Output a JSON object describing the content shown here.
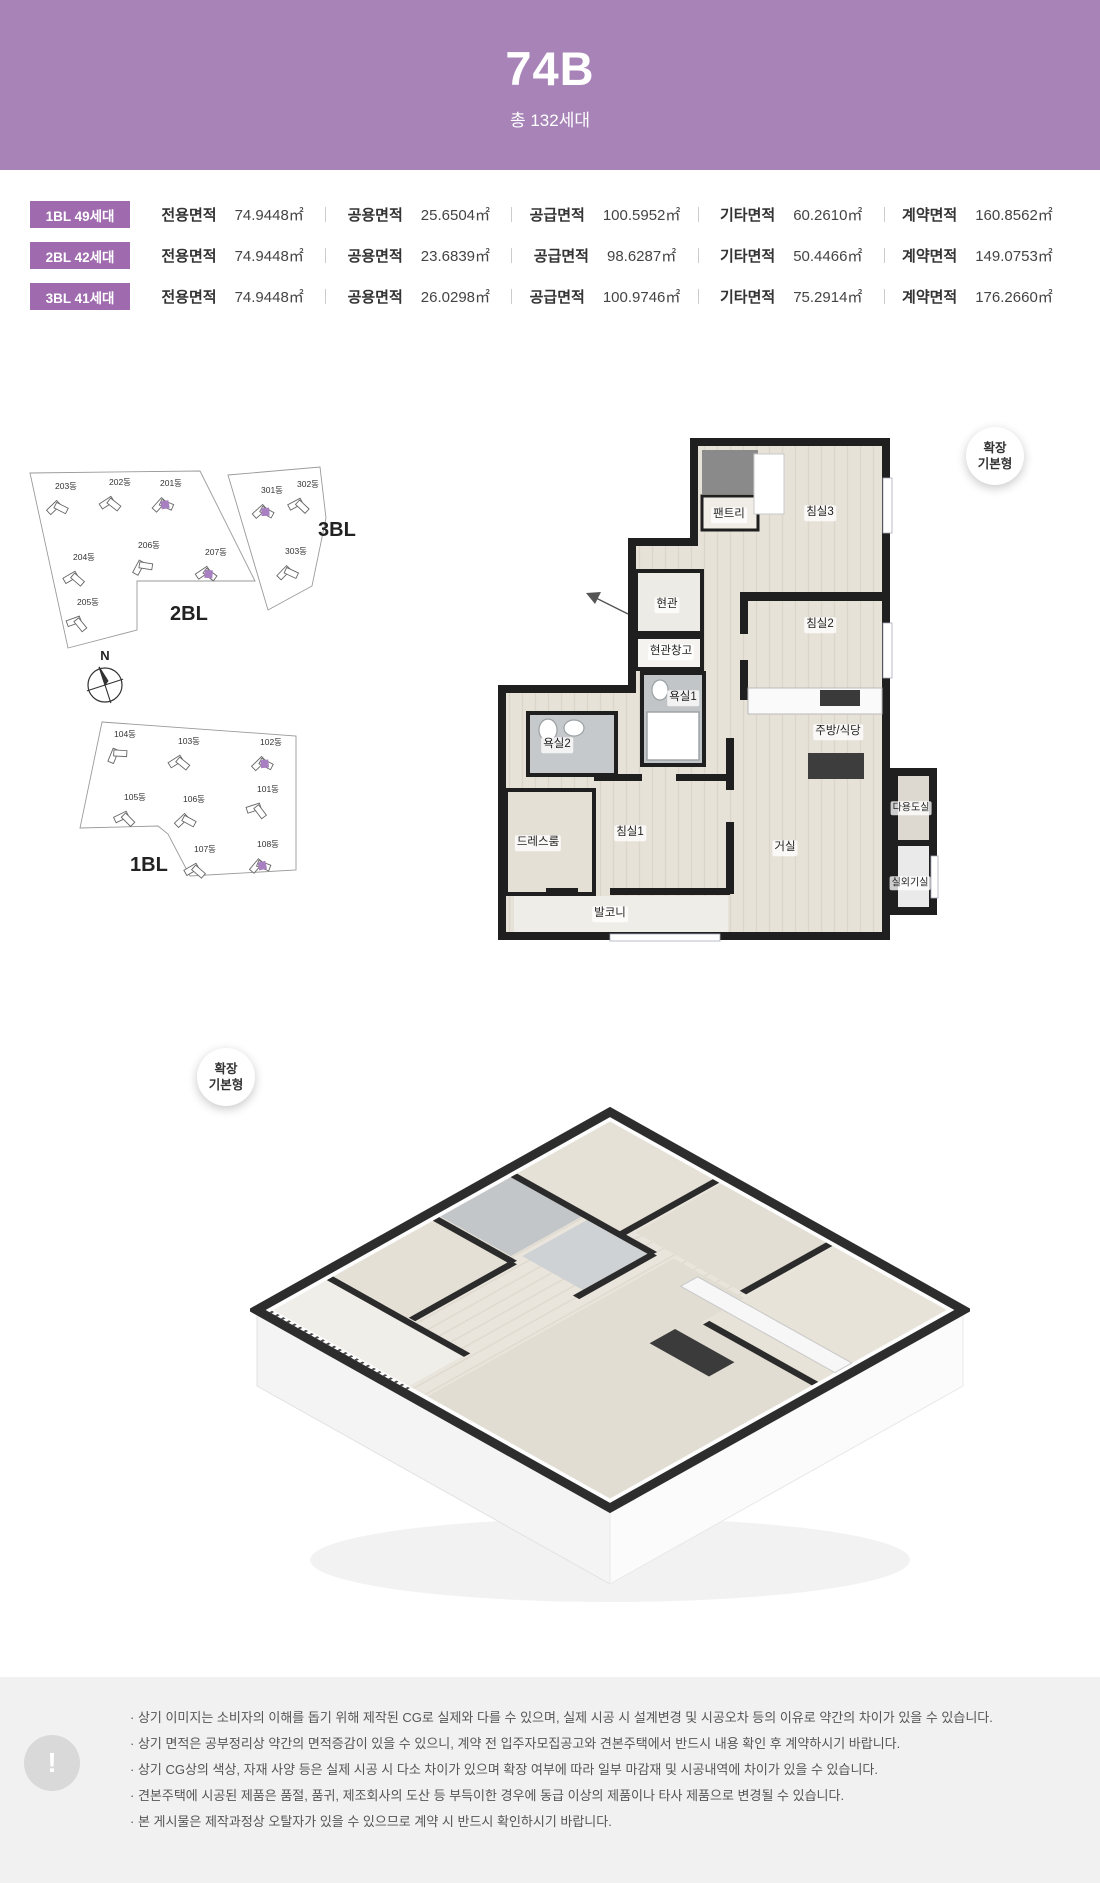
{
  "header": {
    "title": "74B",
    "subtitle": "총 132세대"
  },
  "table": {
    "rows": [
      {
        "badge": "1BL 49세대",
        "cells": [
          [
            "전용면적",
            "74.9448㎡"
          ],
          [
            "공용면적",
            "25.6504㎡"
          ],
          [
            "공급면적",
            "100.5952㎡"
          ],
          [
            "기타면적",
            "60.2610㎡"
          ],
          [
            "계약면적",
            "160.8562㎡"
          ]
        ]
      },
      {
        "badge": "2BL 42세대",
        "cells": [
          [
            "전용면적",
            "74.9448㎡"
          ],
          [
            "공용면적",
            "23.6839㎡"
          ],
          [
            "공급면적",
            "98.6287㎡"
          ],
          [
            "기타면적",
            "50.4466㎡"
          ],
          [
            "계약면적",
            "149.0753㎡"
          ]
        ]
      },
      {
        "badge": "3BL 41세대",
        "cells": [
          [
            "전용면적",
            "74.9448㎡"
          ],
          [
            "공용면적",
            "26.0298㎡"
          ],
          [
            "공급면적",
            "100.9746㎡"
          ],
          [
            "기타면적",
            "75.2914㎡"
          ],
          [
            "계약면적",
            "176.2660㎡"
          ]
        ]
      }
    ]
  },
  "siteplan": {
    "compass_n": "N",
    "bl2": {
      "label": "2BL",
      "buildings": [
        "203동",
        "202동",
        "201동",
        "204동",
        "206동",
        "207동",
        "205동"
      ]
    },
    "bl3": {
      "label": "3BL",
      "buildings": [
        "301동",
        "302동",
        "303동"
      ]
    },
    "bl1": {
      "label": "1BL",
      "buildings": [
        "104동",
        "103동",
        "102동",
        "105동",
        "106동",
        "101동",
        "107동",
        "108동"
      ]
    }
  },
  "floorplan": {
    "badge_line1": "확장",
    "badge_line2": "기본형",
    "rooms": {
      "pantry": "팬트리",
      "bedroom3": "침실3",
      "entrance": "현관",
      "entrance_storage": "현관창고",
      "bathroom1": "욕실1",
      "bedroom2": "침실2",
      "kitchen_dining": "주방/식당",
      "bathroom2": "욕실2",
      "utility": "다용도실",
      "dressroom": "드레스룸",
      "bedroom1": "침실1",
      "living": "거실",
      "outdoor_unit": "실외기실",
      "balcony": "발코니"
    }
  },
  "render3d": {
    "badge_line1": "확장",
    "badge_line2": "기본형"
  },
  "footer": {
    "icon": "!",
    "notes": [
      "· 상기 이미지는 소비자의 이해를 돕기 위해 제작된 CG로 실제와 다를 수 있으며, 실제 시공 시 설계변경 및 시공오차 등의 이유로 약간의 차이가 있을 수 있습니다.",
      "· 상기 면적은 공부정리상 약간의 면적증감이 있을 수 있으니, 계약 전 입주자모집공고와 견본주택에서 반드시 내용 확인 후 계약하시기 바랍니다.",
      "· 상기 CG상의 색상, 자재 사양 등은 실제 시공 시 다소 차이가 있으며 확장 여부에 따라 일부 마감재 및 시공내역에 차이가 있을 수 있습니다.",
      "· 견본주택에 시공된 제품은 품절, 품귀, 제조회사의 도산 등 부득이한 경우에 동급 이상의 제품이나 타사 제품으로 변경될 수 있습니다.",
      "· 본 게시물은 제작과정상 오탈자가 있을 수 있으므로 계약 시 반드시 확인하시기 바랍니다."
    ]
  },
  "colors": {
    "header_bg": "#a783b7",
    "badge_bg": "#9f6bae",
    "highlight_unit": "#a87fc0",
    "wall": "#1f1f1f",
    "footer_bg": "#f1f1f1"
  }
}
